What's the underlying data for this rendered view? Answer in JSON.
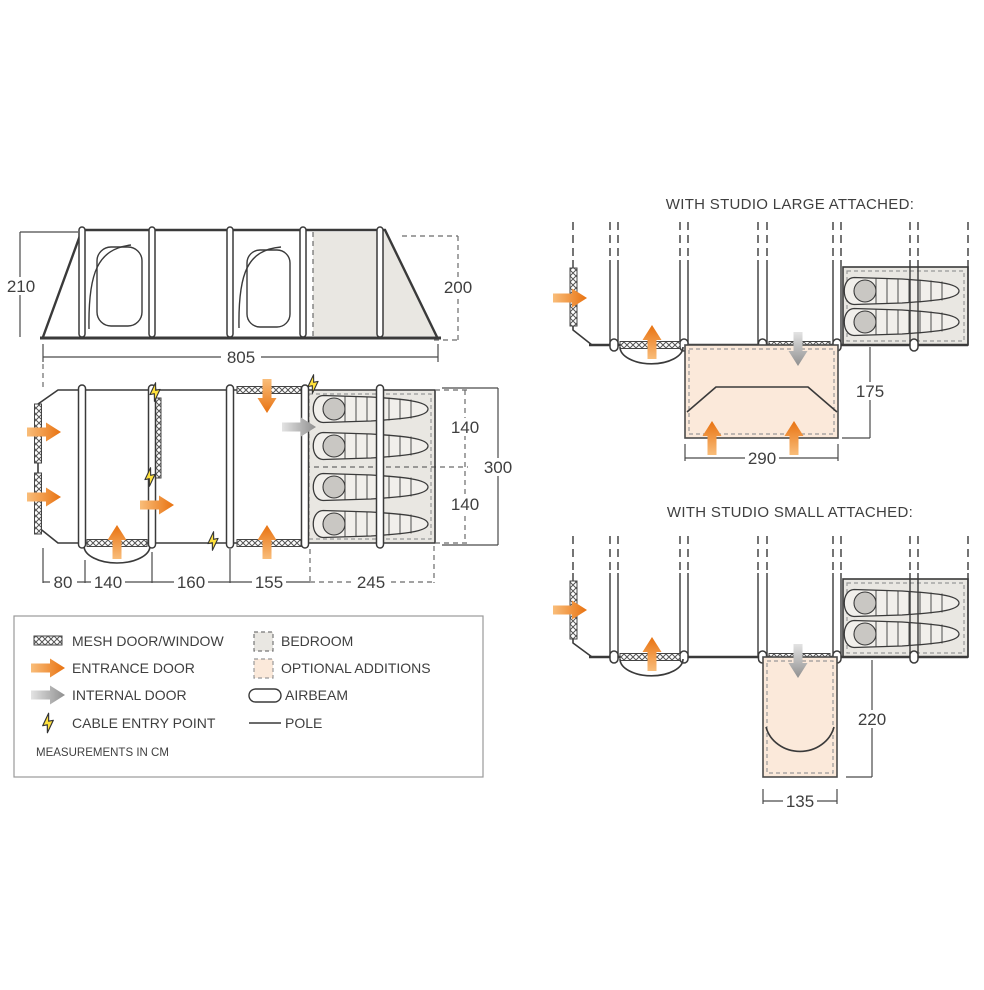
{
  "colors": {
    "outline": "#3a3a3a",
    "bedroom_fill": "#e9e7e2",
    "optional_fill": "#fbe9da",
    "entrance_orange": "#e87210",
    "internal_grey": "#9a9a9a",
    "cable_yellow": "#ffe13d"
  },
  "side_view": {
    "left_height": "210",
    "right_height": "200",
    "length": "805"
  },
  "floor_plan": {
    "sections": [
      "80",
      "140",
      "160",
      "155",
      "245"
    ],
    "bedroom_split": [
      "140",
      "140"
    ],
    "total_depth": "300"
  },
  "studio_large": {
    "title": "WITH STUDIO LARGE ATTACHED:",
    "width": "290",
    "depth": "175"
  },
  "studio_small": {
    "title": "WITH STUDIO SMALL ATTACHED:",
    "width": "135",
    "depth": "220"
  },
  "legend": {
    "left": [
      {
        "icon": "mesh-swatch",
        "label": "MESH DOOR/WINDOW"
      },
      {
        "icon": "entrance-arrow",
        "label": "ENTRANCE DOOR"
      },
      {
        "icon": "internal-arrow",
        "label": "INTERNAL DOOR"
      },
      {
        "icon": "cable-bolt",
        "label": "CABLE ENTRY POINT"
      }
    ],
    "right": [
      {
        "icon": "bedroom-swatch",
        "label": "BEDROOM"
      },
      {
        "icon": "optional-swatch",
        "label": "OPTIONAL ADDITIONS"
      },
      {
        "icon": "airbeam-pill",
        "label": "AIRBEAM"
      },
      {
        "icon": "pole-line",
        "label": "POLE"
      }
    ],
    "note": "MEASUREMENTS IN CM"
  }
}
